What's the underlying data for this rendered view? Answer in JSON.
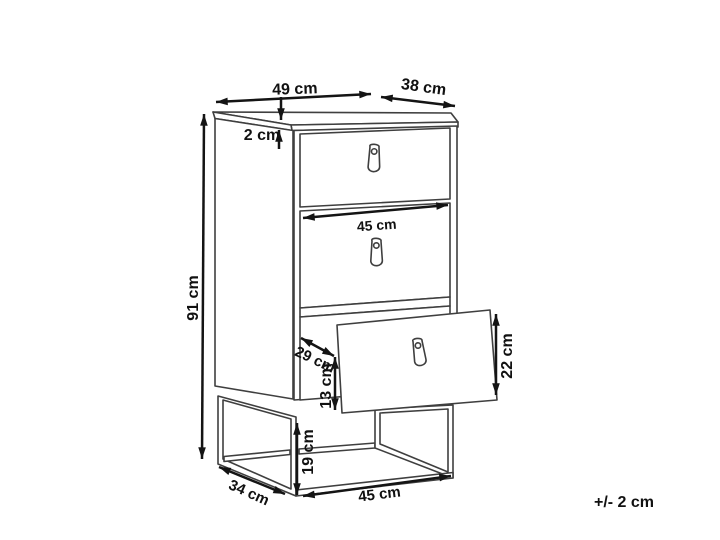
{
  "diagram": {
    "title_hint": "chest of drawers dimension drawing",
    "unit": "cm",
    "labels": {
      "top_width": "49 cm",
      "top_depth": "38 cm",
      "top_thickness": "2 cm",
      "height": "91 cm",
      "drawer_width": "45 cm",
      "inner_depth": "29 cm",
      "inner_front_height": "13 cm",
      "drawer_front_height": "22 cm",
      "leg_height": "19 cm",
      "base_depth": "34 cm",
      "base_width": "45 cm",
      "tolerance": "+/- 2 cm"
    },
    "colors": {
      "background": "#ffffff",
      "outline": "#3f3f3f",
      "pattern": "#c8c8c8",
      "dimension": "#141414",
      "text": "#111111"
    }
  }
}
